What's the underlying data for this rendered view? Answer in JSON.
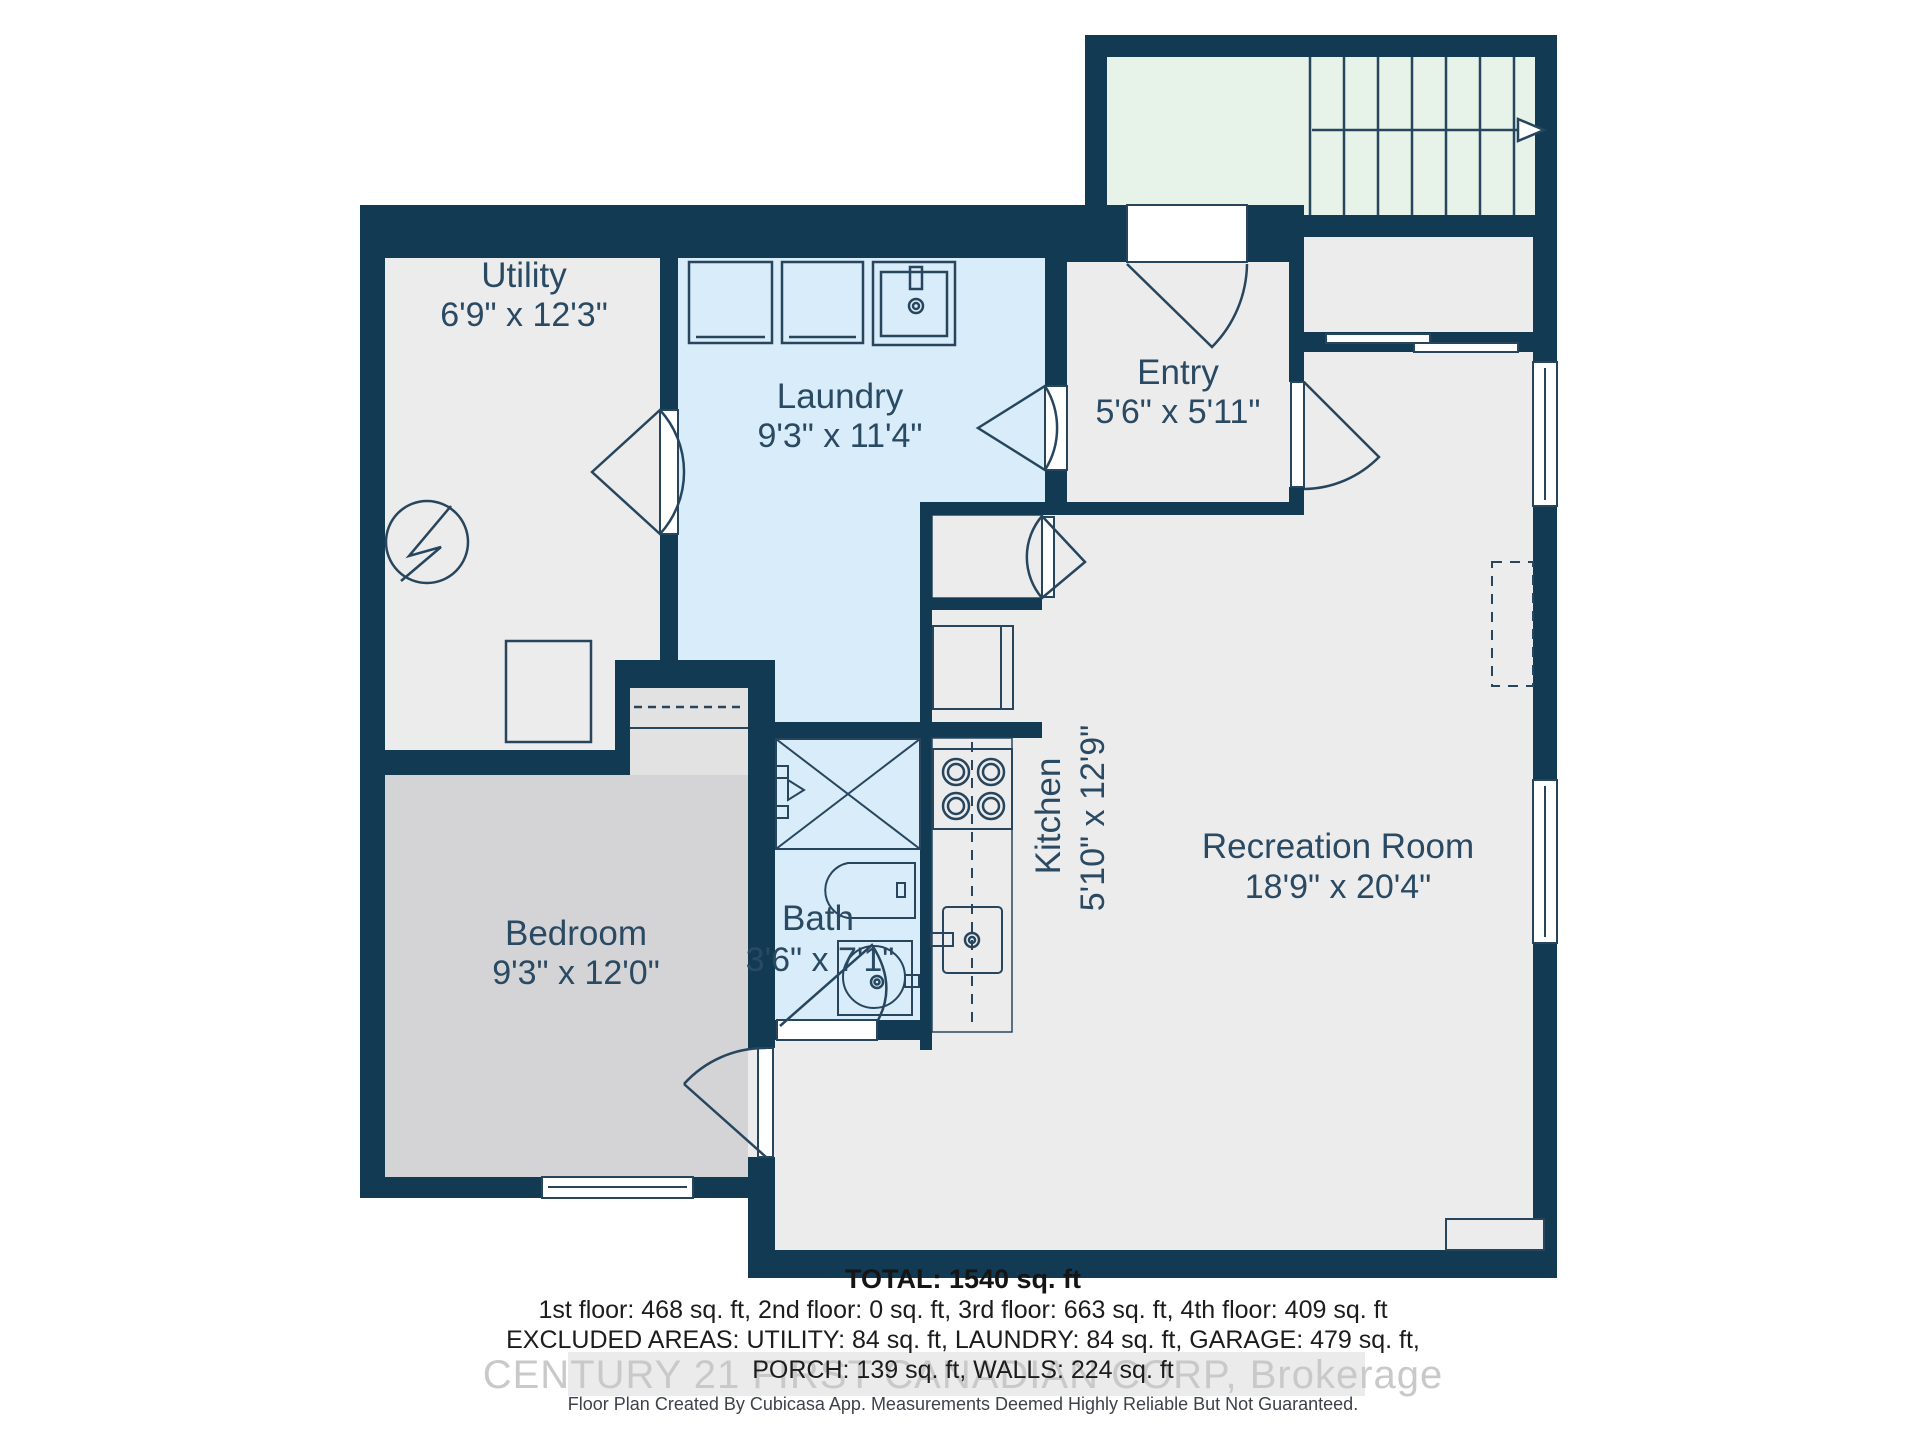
{
  "meta": {
    "document_type": "floor-plan",
    "creator_app": "Cubicasa"
  },
  "rooms": {
    "utility": {
      "name": "Utility",
      "dims": "6'9\" x 12'3\""
    },
    "laundry": {
      "name": "Laundry",
      "dims": "9'3\" x 11'4\""
    },
    "entry": {
      "name": "Entry",
      "dims": "5'6\" x 5'11\""
    },
    "kitchen": {
      "name": "Kitchen",
      "dims": "5'10\" x 12'9\""
    },
    "recreation": {
      "name": "Recreation Room",
      "dims": "18'9\" x 20'4\""
    },
    "bedroom": {
      "name": "Bedroom",
      "dims": "9'3\" x 12'0\""
    },
    "bath": {
      "name": "Bath",
      "dims": "3'6\" x 7'1\""
    }
  },
  "summary": {
    "total": "TOTAL: 1540 sq. ft",
    "floors": "1st floor: 468 sq. ft, 2nd floor: 0 sq. ft, 3rd floor: 663 sq. ft, 4th floor: 409 sq. ft",
    "excluded": "EXCLUDED AREAS: UTILITY: 84 sq. ft, LAUNDRY: 84 sq. ft, GARAGE: 479 sq. ft,",
    "porch": "PORCH: 139 sq. ft, WALLS: 224 sq. ft"
  },
  "watermark": "CENTURY 21 FIRST CANADIAN CORP, Brokerage",
  "disclaimer": "Floor Plan Created By Cubicasa App. Measurements Deemed Highly Reliable But Not Guaranteed.",
  "colors": {
    "wall": "#123a53",
    "floor": "#ececec",
    "bedroom_floor": "#d4d4d6",
    "wet_room_floor": "#d8ecfa",
    "stairs_floor": "#e7f3e8",
    "label": "#2a4a63",
    "watermark": "#c9c9c9"
  },
  "fixtures": [
    "stairs-up-arrow",
    "washer",
    "dryer",
    "laundry-sink",
    "water-heater",
    "furnace",
    "closet-rod",
    "fridge",
    "stove",
    "kitchen-sink",
    "shower",
    "bath-vanity",
    "toilet",
    "hearth",
    "ceiling-beam-dashed",
    "window",
    "sliding-door",
    "door-swing"
  ]
}
